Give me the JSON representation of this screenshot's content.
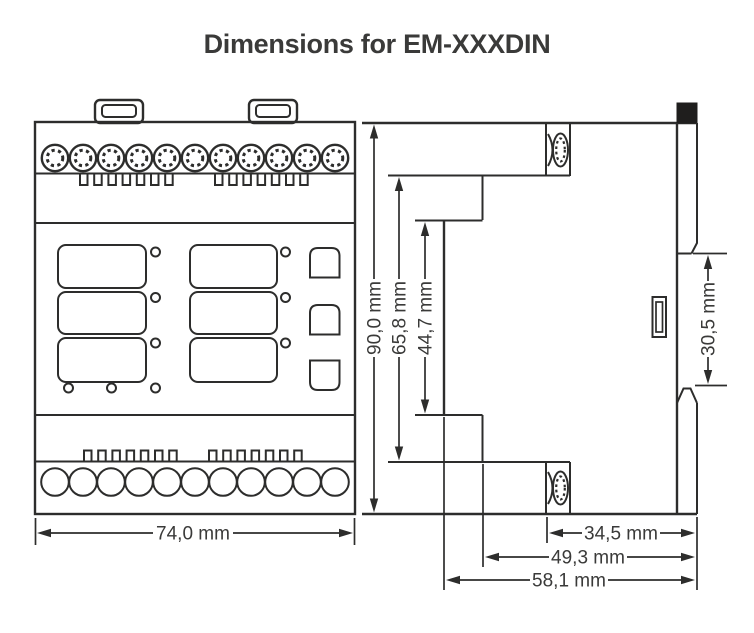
{
  "title": "Dimensions for EM-XXXDIN",
  "colors": {
    "line": "#2d2d2c",
    "text": "#3a3a39",
    "clip_fill": "#1f1e1d",
    "background": "#ffffff"
  },
  "front_view": {
    "width_label": "74,0 mm"
  },
  "side_view": {
    "height_labels": {
      "outer": "90,0 mm",
      "middle": "65,8 mm",
      "inner": "44,7 mm"
    },
    "din_clip_label": "30,5 mm",
    "depth_labels": {
      "inner": "34,5 mm",
      "middle": "49,3 mm",
      "outer": "58,1 mm"
    }
  }
}
